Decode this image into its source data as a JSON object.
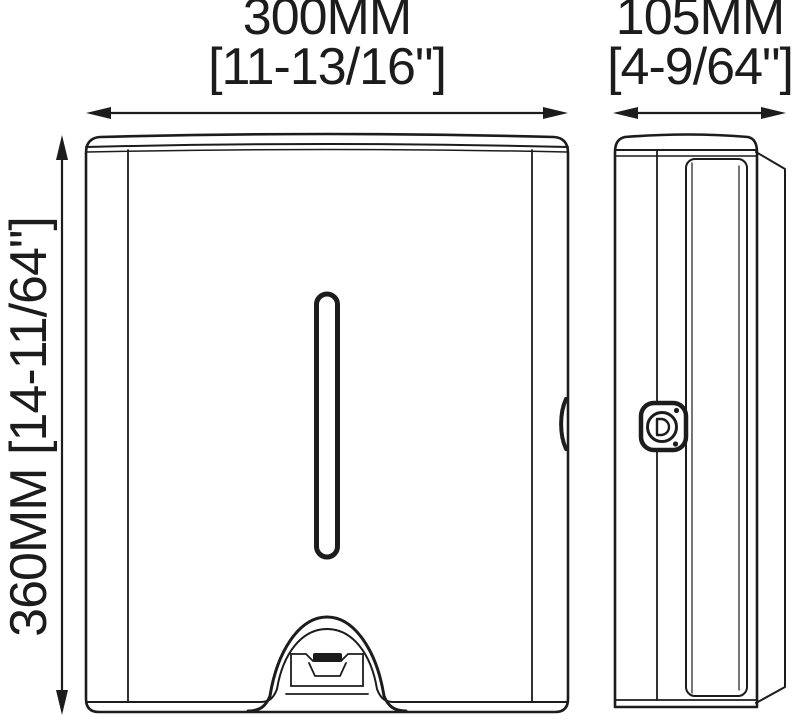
{
  "drawing": {
    "kind": "technical-dimension-diagram",
    "colors": {
      "line": "#1c1c1c",
      "background": "#ffffff"
    }
  },
  "dimensions": {
    "width": {
      "metric": "300MM",
      "imperial": "[11-13/16\"]"
    },
    "depth": {
      "metric": "105MM",
      "imperial": "[4-9/64\"]"
    },
    "height": {
      "label": "360MM [14-11/64\"]"
    }
  }
}
